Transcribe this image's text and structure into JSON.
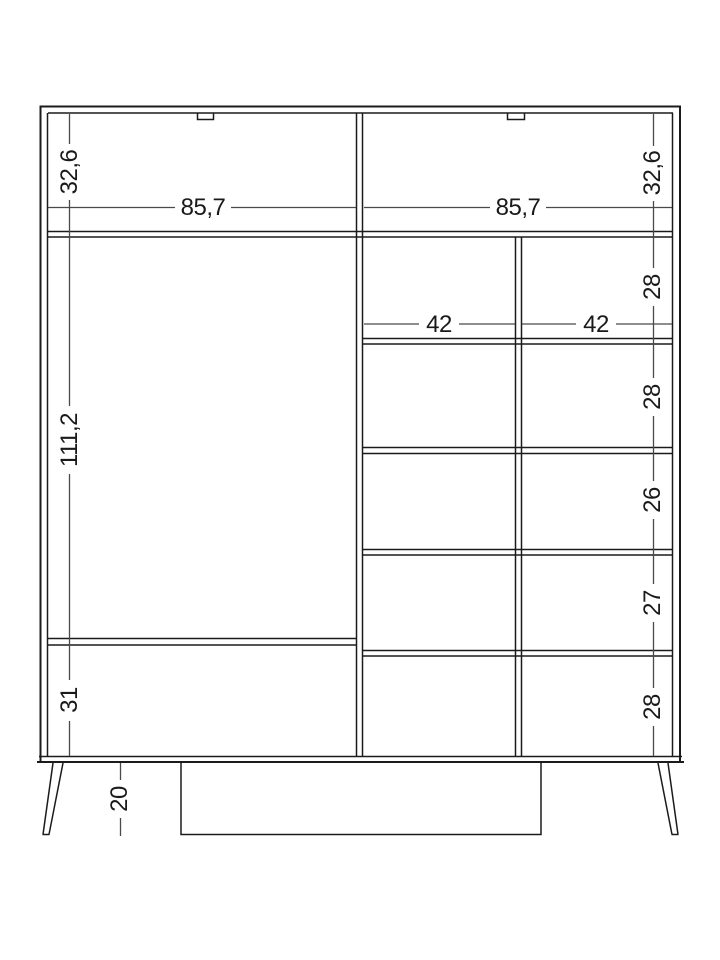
{
  "drawing_title": "wardrobe-dimension-drawing",
  "units": "cm",
  "dims": {
    "left_chain": [
      "32,6",
      "111,2",
      "31"
    ],
    "right_chain": [
      "32,6",
      "28",
      "28",
      "26",
      "27",
      "28"
    ],
    "section_widths": [
      "85,7",
      "85,7"
    ],
    "compartment_widths": [
      "42",
      "42"
    ],
    "leg_height": "20"
  },
  "colors": {
    "background": "#ffffff",
    "line": "#1b1b1b",
    "dim_line": "#4a4a4a",
    "text": "#1a1a1a"
  }
}
